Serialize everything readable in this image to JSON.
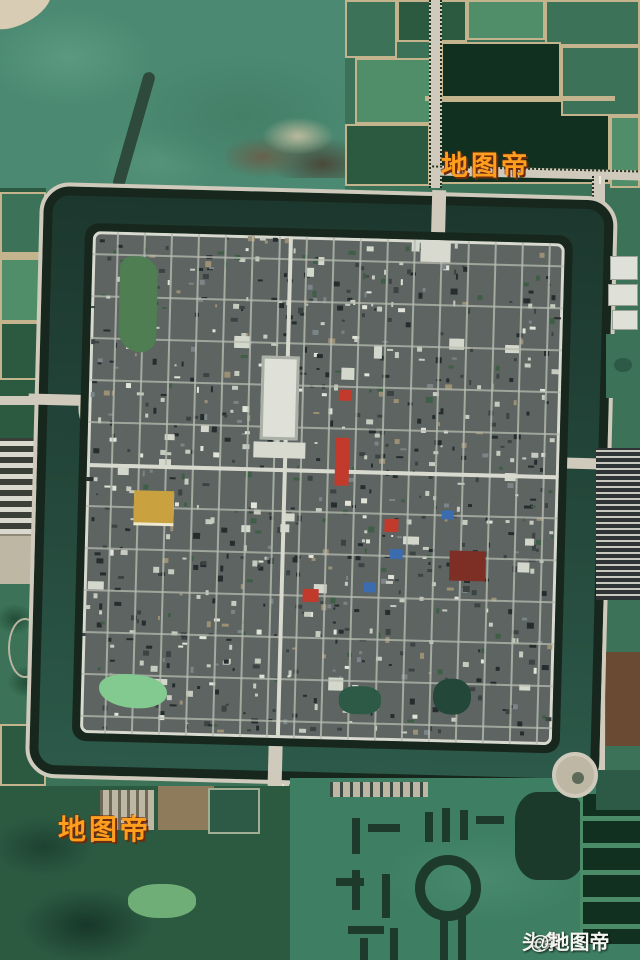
{
  "scene": {
    "description": "aerial satellite photograph of a square ancient walled city surrounded by a moat, farmland, fish ponds and a lake"
  },
  "watermarks": {
    "top_right": {
      "text": "地图帝"
    },
    "bottom_left": {
      "text": "地图帝"
    },
    "bottom_right": {
      "brand": "头条",
      "handle": "@地图帝"
    }
  },
  "colors": {
    "field_base": "#3c7257",
    "field_light": "#4f8e69",
    "field_dark": "#2c5a41",
    "pond_dark": "#12301f",
    "divider": "#c4b48e",
    "lake": "#4b8972",
    "lake_light": "#5b9a80",
    "moat_top": "#1c372e",
    "moat_mid": "#234539",
    "moat_bottom": "#2c5a4a",
    "tree": "#17271d",
    "road": "#cfcabb",
    "road_dash": "#ece9df",
    "city_base": "#5d6462",
    "street": "#b7bbb0",
    "street_main": "#d8dacf",
    "se_water": "#3e7f64",
    "maze": "#1d3a2c",
    "grass_bright": "#6fae77",
    "pond_city": "#4e7e52",
    "pond_bright": "#82ca90",
    "pond_teal": "#2c5a47",
    "dirt": "#8d7b5c",
    "dirt_dark": "#6b4a33",
    "parking": "#bdb7a4",
    "building_white": "#dfe1d8",
    "accent_red": "#c23a2c",
    "accent_darkred": "#7d2e25",
    "accent_blue": "#3b6cb0",
    "accent_gold": "#c9a23f",
    "wm_orange": "#ff9f1d",
    "wm_outline": "#6e2a0c",
    "wm_white": "#f5f6f1"
  }
}
